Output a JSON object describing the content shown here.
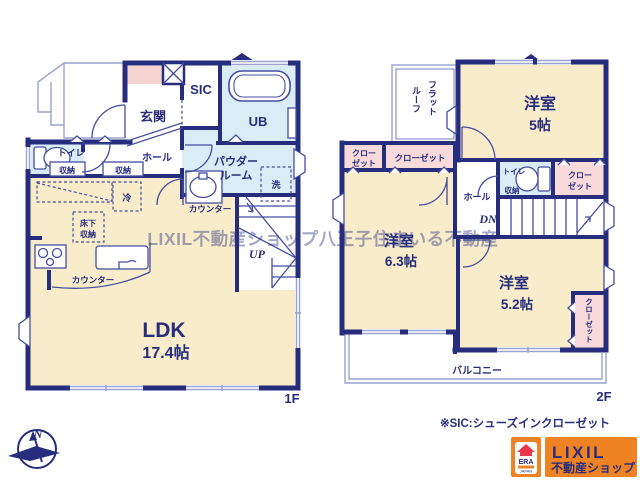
{
  "colors": {
    "wall_navy": "#272d7d",
    "room_cream": "#f8ecca",
    "room_blue": "#daecf5",
    "room_pink": "#f9dada",
    "genkan_pink": "#f6d3d0",
    "logo_orange": "#ef8222",
    "logo_red": "#e8374a",
    "watermark_gray": "#6b6b88"
  },
  "watermark": "LIXIL不動産ショップ八王子住まいる不動産",
  "note": "※SIC:シューズインクローゼット",
  "compass": {
    "north": "N"
  },
  "floor1": {
    "label": "1F",
    "genkan": "玄関",
    "sic": "SIC",
    "ub": "UB",
    "toilet": "トイレ",
    "storage_a": "収納",
    "storage_b": "収納",
    "hall": "ホール",
    "powder_l1": "パウダー",
    "powder_l2": "ルーム",
    "laundry": "洗",
    "counter_a": "カウンター",
    "counter_b": "カウンター",
    "fridge": "冷",
    "underfloor_l1": "床下",
    "underfloor_l2": "収納",
    "ldk": "LDK",
    "ldk_size": "17.4帖",
    "up": "UP"
  },
  "floor2": {
    "label": "2F",
    "room5": "洋室",
    "room5_size": "5帖",
    "flatroof_l1": "フラット",
    "flatroof_l2": "ルーフ",
    "closet_a_l1": "クロー",
    "closet_a_l2": "ゼット",
    "closet_b": "クローゼット",
    "room63": "洋室",
    "room63_size": "6.3帖",
    "hall": "ホール",
    "dn": "DN",
    "toilet": "トイレ",
    "storage": "収納",
    "closet_c_l1": "クロー",
    "closet_c_l2": "ゼット",
    "room52": "洋室",
    "room52_size": "5.2帖",
    "closet_d": "クローゼット",
    "balcony": "バルコニー"
  },
  "logo": {
    "brand": "LIXIL",
    "sub": "不動産ショップ",
    "era": "ERA",
    "japan": "JAPAN"
  }
}
